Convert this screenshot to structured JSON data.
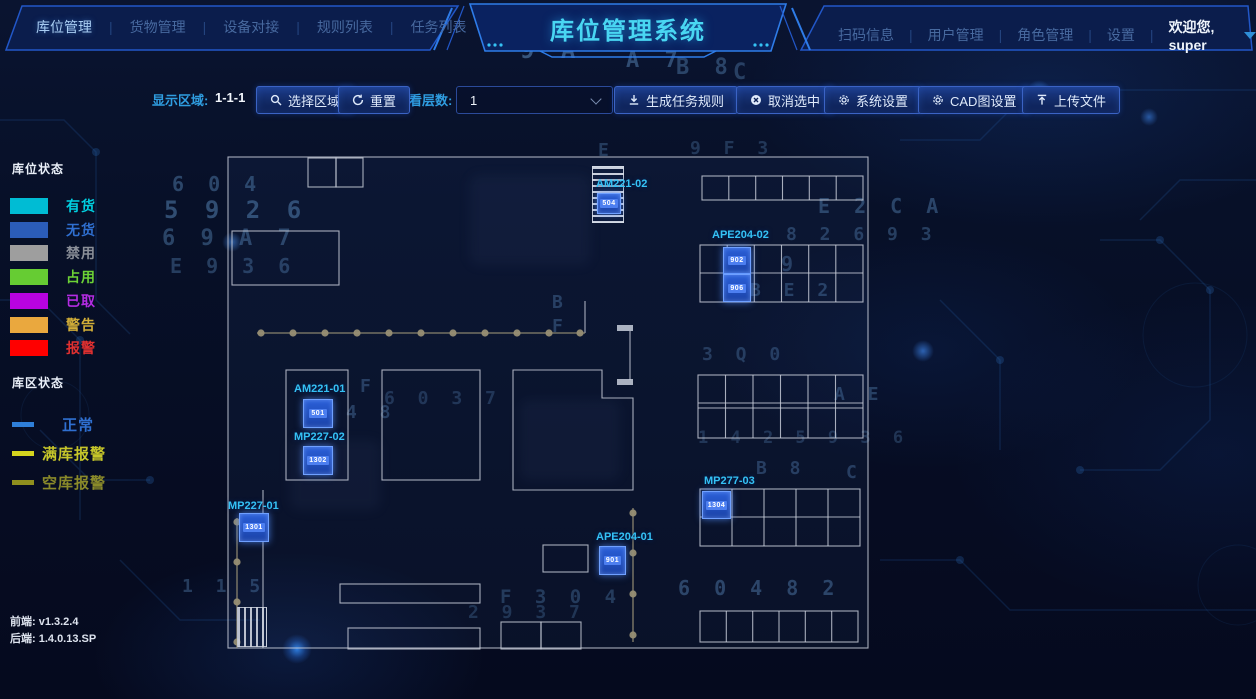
{
  "header": {
    "nav_left": [
      {
        "label": "库位管理",
        "active": true
      },
      {
        "label": "货物管理",
        "active": false
      },
      {
        "label": "设备对接",
        "active": false
      },
      {
        "label": "规则列表",
        "active": false
      },
      {
        "label": "任务列表",
        "active": false
      }
    ],
    "title": "库位管理系统",
    "nav_right": [
      {
        "label": "扫码信息"
      },
      {
        "label": "用户管理"
      },
      {
        "label": "角色管理"
      },
      {
        "label": "设置"
      }
    ],
    "divider": "|",
    "welcome": "欢迎您, super"
  },
  "toolbar": {
    "display_area_label": "显示区域:",
    "display_area_value": "1-1-1",
    "left_buttons": [
      {
        "icon": "search-icon",
        "label": "选择区域"
      },
      {
        "icon": "refresh-icon",
        "label": "重置"
      }
    ],
    "layer_label": "查看层数:",
    "layer_value": "1",
    "action_buttons": [
      {
        "icon": "download-icon",
        "label": "生成任务规则"
      },
      {
        "icon": "cancel-icon",
        "label": "取消选中"
      },
      {
        "icon": "gear-icon",
        "label": "系统设置"
      },
      {
        "icon": "gear-icon",
        "label": "CAD图设置"
      },
      {
        "icon": "upload-icon",
        "label": "上传文件"
      }
    ]
  },
  "legend": {
    "slot_status_title": "库位状态",
    "slot_statuses": [
      {
        "label": "有货",
        "color": "#00bcd4",
        "text_color": "#00cfe0"
      },
      {
        "label": "无货",
        "color": "#2b5cb8",
        "text_color": "#2f6fd0"
      },
      {
        "label": "禁用",
        "color": "#9e9e9e",
        "text_color": "#8a8f98"
      },
      {
        "label": "占用",
        "color": "#66cc33",
        "text_color": "#6cd236"
      },
      {
        "label": "已取",
        "color": "#b803e0",
        "text_color": "#b42ce2"
      },
      {
        "label": "警告",
        "color": "#eaa83e",
        "text_color": "#d2ae38"
      },
      {
        "label": "报警",
        "color": "#ff0000",
        "text_color": "#e03030"
      }
    ],
    "zone_status_title": "库区状态",
    "zone_statuses": [
      {
        "label": "正常",
        "color": "#2f7fd9",
        "text_color": "#2f6fd0"
      },
      {
        "label": "满库报警",
        "color": "#d4d41e",
        "text_color": "#c6c62a"
      },
      {
        "label": "空库报警",
        "color": "#8f8f1e",
        "text_color": "#8a8a2a"
      }
    ]
  },
  "versions": {
    "frontend": "前端:  v1.3.2.4",
    "backend": "后端:  1.4.0.13.SP"
  },
  "plan": {
    "locations": [
      {
        "id": "AM221-02",
        "cells": [
          "504"
        ]
      },
      {
        "id": "APE204-02",
        "cells": [
          "902",
          "906"
        ]
      },
      {
        "id": "AM221-01",
        "cells": [
          "501"
        ]
      },
      {
        "id": "MP227-02",
        "cells": [
          "1302"
        ]
      },
      {
        "id": "MP227-01",
        "cells": [
          "1301"
        ]
      },
      {
        "id": "APE204-01",
        "cells": [
          "901"
        ]
      },
      {
        "id": "MP277-03",
        "cells": [
          "1304"
        ]
      }
    ]
  },
  "background_glyphs": [
    {
      "t": "9 A",
      "x": 520,
      "y": 36,
      "s": 24,
      "o": 0.45
    },
    {
      "t": "A 7",
      "x": 626,
      "y": 48,
      "s": 22,
      "o": 0.38
    },
    {
      "t": "B 8",
      "x": 676,
      "y": 55,
      "s": 22,
      "o": 0.33
    },
    {
      "t": "C",
      "x": 733,
      "y": 60,
      "s": 22,
      "o": 0.3
    },
    {
      "t": "6 0 4",
      "x": 172,
      "y": 172,
      "s": 20,
      "o": 0.35
    },
    {
      "t": "5 9 2 6",
      "x": 164,
      "y": 196,
      "s": 24,
      "o": 0.4
    },
    {
      "t": "6 9 A 7",
      "x": 162,
      "y": 226,
      "s": 22,
      "o": 0.34
    },
    {
      "t": "E 9 3 6",
      "x": 170,
      "y": 254,
      "s": 20,
      "o": 0.3
    },
    {
      "t": "E 2 C   A",
      "x": 818,
      "y": 194,
      "s": 20,
      "o": 0.34
    },
    {
      "t": "8 2 6 9 3",
      "x": 786,
      "y": 224,
      "s": 18,
      "o": 0.3
    },
    {
      "t": "9",
      "x": 781,
      "y": 252,
      "s": 20,
      "o": 0.3
    },
    {
      "t": "B E 2",
      "x": 750,
      "y": 280,
      "s": 18,
      "o": 0.3
    },
    {
      "t": "B",
      "x": 552,
      "y": 292,
      "s": 18,
      "o": 0.3
    },
    {
      "t": "F",
      "x": 552,
      "y": 316,
      "s": 18,
      "o": 0.3
    },
    {
      "t": "3 Q 0",
      "x": 702,
      "y": 344,
      "s": 18,
      "o": 0.28
    },
    {
      "t": "F",
      "x": 360,
      "y": 376,
      "s": 18,
      "o": 0.3
    },
    {
      "t": "4 8",
      "x": 346,
      "y": 402,
      "s": 18,
      "o": 0.3
    },
    {
      "t": "6 0 3 7",
      "x": 384,
      "y": 388,
      "s": 18,
      "o": 0.24
    },
    {
      "t": "A E",
      "x": 834,
      "y": 384,
      "s": 18,
      "o": 0.3
    },
    {
      "t": "1 4 2 5 9 3 6",
      "x": 698,
      "y": 428,
      "s": 17,
      "o": 0.24
    },
    {
      "t": "B 8",
      "x": 756,
      "y": 458,
      "s": 18,
      "o": 0.3
    },
    {
      "t": "C",
      "x": 846,
      "y": 462,
      "s": 18,
      "o": 0.3
    },
    {
      "t": "1 1 5",
      "x": 182,
      "y": 576,
      "s": 18,
      "o": 0.3
    },
    {
      "t": "F 3   0 4",
      "x": 500,
      "y": 586,
      "s": 19,
      "o": 0.28
    },
    {
      "t": "6 0 4 8 2",
      "x": 678,
      "y": 576,
      "s": 20,
      "o": 0.35
    },
    {
      "t": "2 9 3 7",
      "x": 468,
      "y": 602,
      "s": 18,
      "o": 0.24
    },
    {
      "t": "9 F 3",
      "x": 690,
      "y": 138,
      "s": 18,
      "o": 0.25
    },
    {
      "t": "E",
      "x": 598,
      "y": 140,
      "s": 18,
      "o": 0.28
    }
  ]
}
